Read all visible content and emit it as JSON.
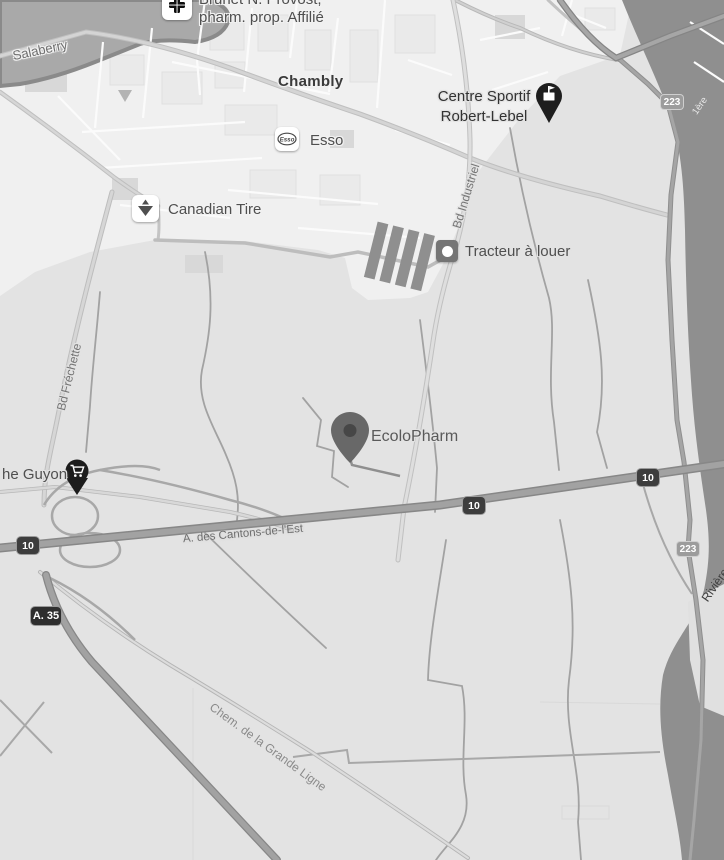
{
  "colors": {
    "land": "#e3e3e3",
    "urban_area": "#f0f0f0",
    "water": "#8f8f8f",
    "highway_fill": "#a2a2a2",
    "road_casing": "#878787",
    "dark_building": "#8f8f8f",
    "poi_label": "#4f4f4f",
    "shield_dark_bg": "#3d3d3d",
    "shield_gray_bg": "#9c9c9c"
  },
  "city": {
    "name": "Chambly"
  },
  "pois": {
    "brunet": {
      "name_line1": "Brunet N. Provost,",
      "name_line2": "pharm. prop. Affilié"
    },
    "esso": {
      "name": "Esso"
    },
    "canadian_tire": {
      "name": "Canadian Tire"
    },
    "centre_sportif": {
      "name_line1": "Centre Sportif",
      "name_line2": "Robert-Lebel"
    },
    "tracteur": {
      "name": "Tracteur à louer"
    },
    "ecolopharm": {
      "name": "EcoloPharm"
    },
    "marche_guyon": {
      "name_partial": "he Guyon"
    }
  },
  "roads": {
    "salaberry": "Salaberry",
    "frechette": "Bd Fréchette",
    "industriel": "Bd Industriel",
    "cantons_est": "A. des Cantons-de-l'Est",
    "grande_ligne": "Chem. de la Grande Ligne",
    "riviere": "Rivière",
    "rue_1ere": "1ère"
  },
  "shields": {
    "autoroute_10": "10",
    "autoroute_35": "A. 35",
    "route_223": "223"
  }
}
